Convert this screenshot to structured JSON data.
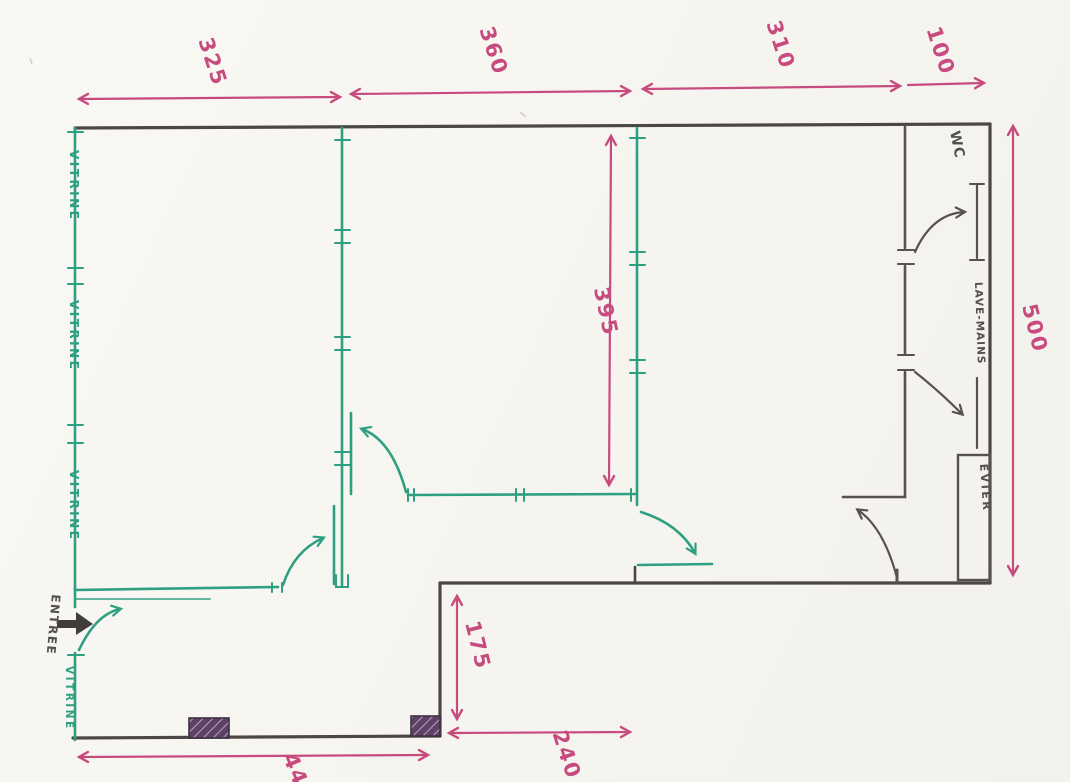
{
  "drawing": {
    "type": "hand-drawn floor plan sketch",
    "labels": {
      "wc": "WC",
      "lave_mains": "LAVE-MAINS",
      "evier": "EVIER",
      "entree": "ENTREE",
      "vitrine": "VITRINE"
    },
    "dimensions": {
      "top_segments": [
        "325",
        "360",
        "310",
        "100"
      ],
      "right_height": "500",
      "inner_room_height": "395",
      "recess_height": "175",
      "recess_width": "240",
      "bottom_width": "440"
    },
    "colors": {
      "paper": "#f8f6f1",
      "wall_black": "#4a4744",
      "partition_green": "#2f9f82",
      "dimension_pink": "#c74b7e",
      "hatch_purple": "#7d4b8f"
    }
  }
}
